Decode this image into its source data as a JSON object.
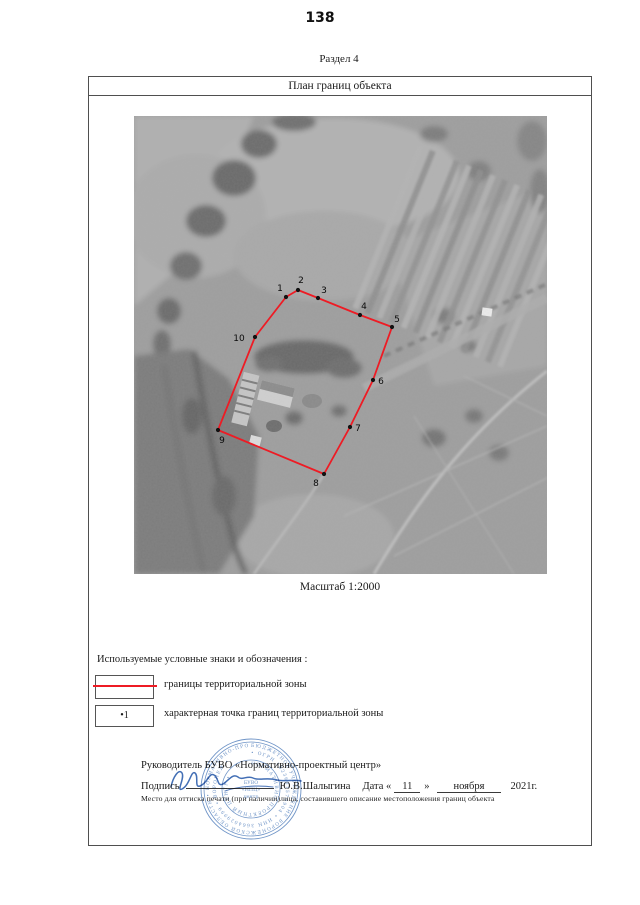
{
  "page": {
    "number": "138",
    "section_label": "Раздел 4"
  },
  "plan": {
    "title": "План границ объекта",
    "scale_label": "Масштаб 1:2000"
  },
  "map": {
    "boundary_color": "#ee1b24",
    "point_color": "#111111",
    "points": [
      {
        "n": "1",
        "x": 152,
        "y": 181,
        "lx": 146,
        "ly": 175
      },
      {
        "n": "2",
        "x": 164,
        "y": 174,
        "lx": 167,
        "ly": 167
      },
      {
        "n": "3",
        "x": 184,
        "y": 182,
        "lx": 190,
        "ly": 177
      },
      {
        "n": "4",
        "x": 226,
        "y": 199,
        "lx": 230,
        "ly": 193
      },
      {
        "n": "5",
        "x": 258,
        "y": 211,
        "lx": 263,
        "ly": 206
      },
      {
        "n": "6",
        "x": 239,
        "y": 264,
        "lx": 247,
        "ly": 268
      },
      {
        "n": "7",
        "x": 216,
        "y": 311,
        "lx": 224,
        "ly": 315
      },
      {
        "n": "8",
        "x": 190,
        "y": 358,
        "lx": 182,
        "ly": 370
      },
      {
        "n": "9",
        "x": 84,
        "y": 314,
        "lx": 88,
        "ly": 327
      },
      {
        "n": "10",
        "x": 121,
        "y": 221,
        "lx": 105,
        "ly": 225
      }
    ]
  },
  "legend": {
    "title": "Используемые условные знаки и обозначения :",
    "items": [
      {
        "label": "границы территориальной зоны"
      },
      {
        "symbol_text": "•1",
        "label": "характерная точка границ территориальной зоны"
      }
    ]
  },
  "signature": {
    "head": "Руководитель БУВО «Нормативно-проектный центр»",
    "sign_label": "Подпись",
    "name": "Ю.В.Шалыгина",
    "date_label": "Дата «",
    "day": "11",
    "quote_close": "»",
    "month": "ноября",
    "year": "2021г.",
    "note": "Место для оттиска печати (при наличии)лица, составившего описание местоположения границ объекта"
  }
}
